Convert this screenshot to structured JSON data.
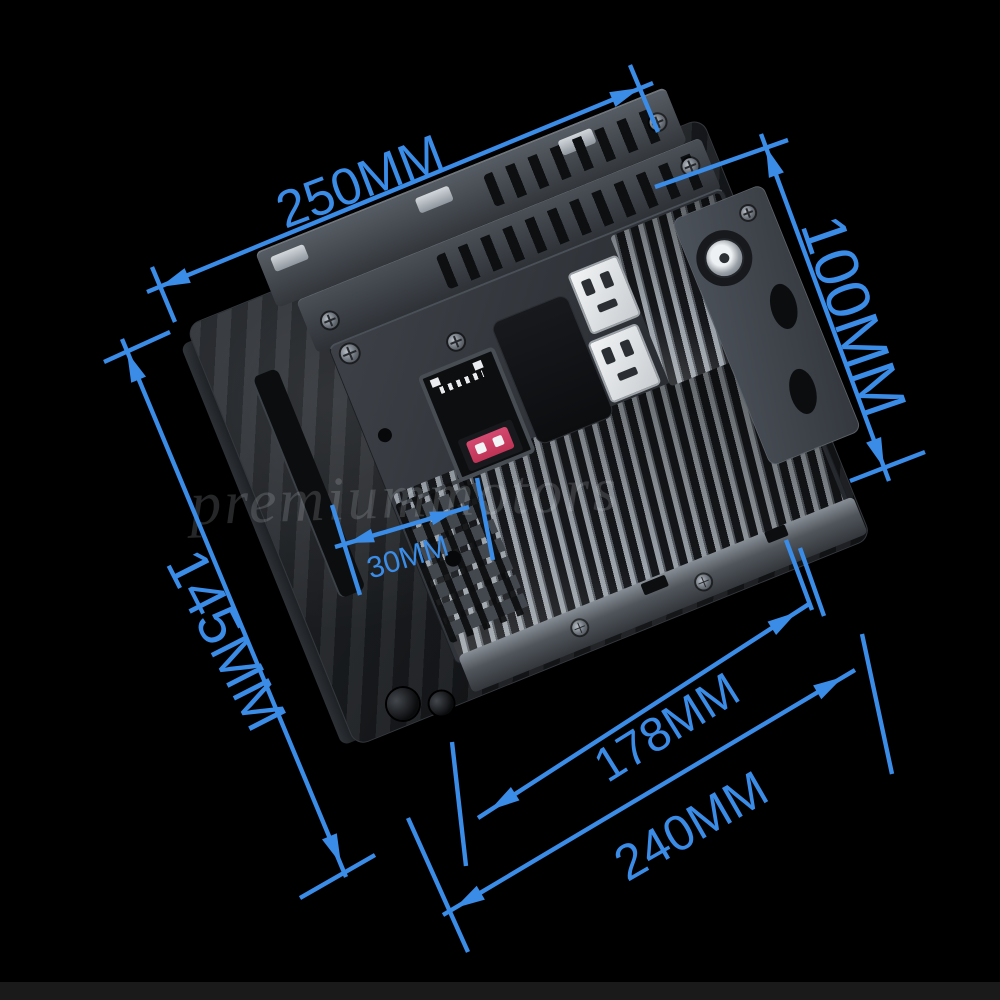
{
  "scene": {
    "background_color": "#000000",
    "bottom_bar_color": "#1a1a1a",
    "watermark_text": "premiummotors"
  },
  "annotation": {
    "color": "#3a8ce6",
    "dimensions": [
      {
        "id": "top-width",
        "label": "250MM"
      },
      {
        "id": "right-height",
        "label": "100MM"
      },
      {
        "id": "left-height",
        "label": "145MM"
      },
      {
        "id": "mount-offset",
        "label": "30MM"
      },
      {
        "id": "inner-width",
        "label": "178MM"
      },
      {
        "id": "bottom-width",
        "label": "240MM"
      }
    ]
  },
  "device": {
    "colors": {
      "fuse_red": "#bf3356",
      "chassis_gray": "#34383e"
    },
    "parts": [
      "rear-shell",
      "mounting-bracket-strip-upper",
      "mounting-bracket-strip-lower",
      "vent-slots",
      "chassis-plate",
      "heatsink-fins",
      "iso-harness-socket",
      "blade-fuse",
      "wiring-socket-upper",
      "wiring-socket-lower",
      "antenna-jack",
      "side-mounting-bracket",
      "bottom-rail",
      "mounting-posts"
    ]
  }
}
